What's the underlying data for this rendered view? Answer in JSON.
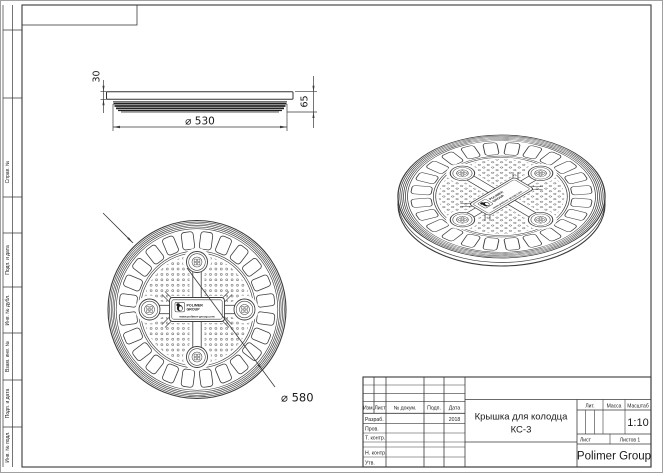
{
  "sheet": {
    "margin_labels": [
      "Справ. №",
      "Подп. и дата",
      "Инв. № дубл.",
      "Взам. инв. №",
      "Подп. и дата",
      "Инв. № подл."
    ]
  },
  "side_view": {
    "dim_top_height": "30",
    "dim_total_height": "65",
    "dim_rib_diameter": "⌀ 530"
  },
  "plan_view": {
    "dim_outer_diameter": "⌀ 580"
  },
  "cover_label": {
    "brand_top": "POLIMER",
    "brand_bottom": "GROUP",
    "website": "www.polimer-group.com"
  },
  "title_block": {
    "columns": [
      "Изм.",
      "Лист",
      "№ докум.",
      "Подп.",
      "Дата"
    ],
    "row_labels": [
      "Разраб.",
      "Пров.",
      "Т. контр.",
      "Н. контр.",
      "Утв."
    ],
    "date": "2018",
    "doc_title_line1": "Крышка для колодца",
    "doc_title_line2": "КС-3",
    "lit_label": "Лит.",
    "mass_label": "Масса",
    "scale_label": "Масштаб",
    "scale_value": "1:10",
    "sheet_label": "Лист",
    "sheets_total_label": "Листов 1",
    "company": "Polimer Group"
  }
}
